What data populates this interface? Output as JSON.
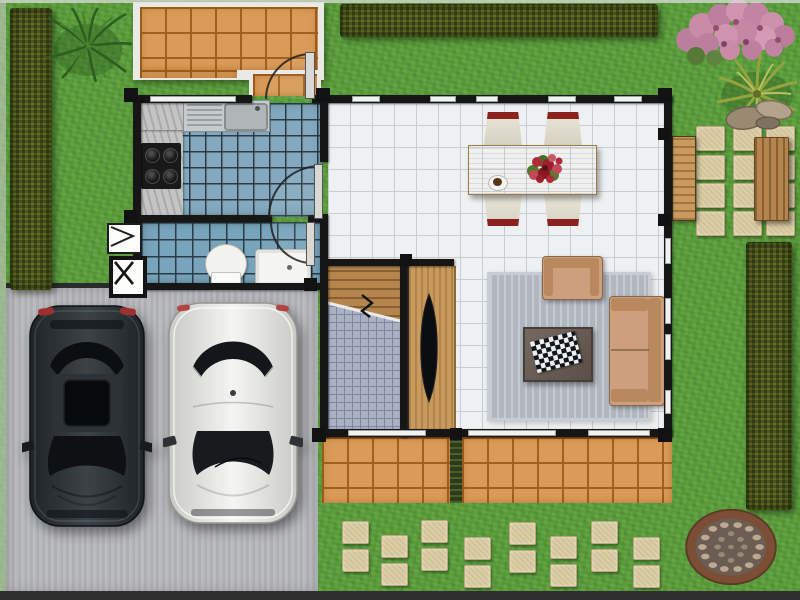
{
  "scene": {
    "name": "house-floor-plan-top-view",
    "width": 800,
    "height": 600
  },
  "palette": {
    "grass": "#5ca03c",
    "hedge": "#4a5520",
    "patioTile": "#d99b57",
    "patioGrout": "#a2601e",
    "kitchenTile": "#84a9be",
    "bathTile": "#79a5bc",
    "tileGrout": "#2b3b47",
    "floorTile": "#eef0f1",
    "floorGrout": "#c8cdd2",
    "wall": "#161616",
    "driveway": "#babbbf",
    "wood": "#b5854e",
    "woodDark": "#8a5f33",
    "rug": "#b1b7c0",
    "sofa": "#cd9f7c",
    "sofaDark": "#b8895f",
    "tableWood": "#d9ba7d",
    "stone": "#dccfa7",
    "stoneBorder": "#b9a87c",
    "wellRing": "#7c4e36",
    "chairSeat": "#e9e5d8",
    "chairBack": "#8c2220",
    "counter": "#c4c4c2",
    "stainless": "#c6cacc",
    "white": "#f2f2ef"
  },
  "garden": {
    "hedges": [
      {
        "name": "hedge-left",
        "x": 10,
        "y": 8,
        "w": 42,
        "h": 282
      },
      {
        "name": "hedge-top",
        "x": 340,
        "y": 4,
        "w": 318,
        "h": 33
      },
      {
        "name": "hedge-right",
        "x": 746,
        "y": 242,
        "w": 46,
        "h": 268
      }
    ],
    "plants": [
      {
        "name": "ornamental-grass"
      },
      {
        "name": "blossom-tree"
      },
      {
        "name": "palm-plant"
      },
      {
        "name": "rock-cluster"
      }
    ],
    "right_path_stones": [
      {
        "x": 696,
        "y": 126,
        "w": 27,
        "h": 23
      },
      {
        "x": 733,
        "y": 126,
        "w": 27,
        "h": 23
      },
      {
        "x": 766,
        "y": 126,
        "w": 27,
        "h": 23
      },
      {
        "x": 696,
        "y": 155,
        "w": 27,
        "h": 23
      },
      {
        "x": 733,
        "y": 155,
        "w": 27,
        "h": 23
      },
      {
        "x": 766,
        "y": 155,
        "w": 27,
        "h": 23
      },
      {
        "x": 696,
        "y": 183,
        "w": 27,
        "h": 23
      },
      {
        "x": 733,
        "y": 183,
        "w": 27,
        "h": 23
      },
      {
        "x": 766,
        "y": 183,
        "w": 27,
        "h": 23
      },
      {
        "x": 696,
        "y": 211,
        "w": 27,
        "h": 23
      },
      {
        "x": 733,
        "y": 211,
        "w": 27,
        "h": 23
      },
      {
        "x": 766,
        "y": 211,
        "w": 27,
        "h": 23
      }
    ],
    "bottom_path_stones": [
      {
        "x": 342,
        "y": 521,
        "w": 25,
        "h": 21
      },
      {
        "x": 342,
        "y": 549,
        "w": 25,
        "h": 21
      },
      {
        "x": 381,
        "y": 535,
        "w": 25,
        "h": 21
      },
      {
        "x": 381,
        "y": 563,
        "w": 25,
        "h": 21
      },
      {
        "x": 421,
        "y": 520,
        "w": 25,
        "h": 21
      },
      {
        "x": 421,
        "y": 548,
        "w": 25,
        "h": 21
      },
      {
        "x": 464,
        "y": 537,
        "w": 25,
        "h": 21
      },
      {
        "x": 464,
        "y": 565,
        "w": 25,
        "h": 21
      },
      {
        "x": 509,
        "y": 522,
        "w": 25,
        "h": 21
      },
      {
        "x": 509,
        "y": 550,
        "w": 25,
        "h": 21
      },
      {
        "x": 550,
        "y": 536,
        "w": 25,
        "h": 21
      },
      {
        "x": 550,
        "y": 564,
        "w": 25,
        "h": 21
      },
      {
        "x": 591,
        "y": 521,
        "w": 25,
        "h": 21
      },
      {
        "x": 591,
        "y": 549,
        "w": 25,
        "h": 21
      },
      {
        "x": 633,
        "y": 537,
        "w": 25,
        "h": 21
      },
      {
        "x": 633,
        "y": 565,
        "w": 25,
        "h": 21
      }
    ],
    "bench": {
      "x": 754,
      "y": 137,
      "w": 33,
      "h": 82
    },
    "pebble_circle": {
      "x": 683,
      "y": 506,
      "w": 96,
      "h": 82
    }
  },
  "driveway": {
    "x": 6,
    "y": 288,
    "w": 312,
    "h": 304,
    "cars": [
      {
        "name": "dark-car",
        "body": "#2e3438"
      },
      {
        "name": "white-car",
        "body": "#ececea"
      }
    ]
  },
  "house": {
    "rooms": [
      {
        "name": "front-patio"
      },
      {
        "name": "kitchen"
      },
      {
        "name": "bathroom"
      },
      {
        "name": "living-dining-room"
      },
      {
        "name": "staircase"
      },
      {
        "name": "rear-terrace"
      }
    ],
    "windows": [
      {
        "x": 150,
        "y": 96,
        "w": 86,
        "h": 6
      },
      {
        "x": 352,
        "y": 96,
        "w": 28,
        "h": 6
      },
      {
        "x": 430,
        "y": 96,
        "w": 26,
        "h": 6
      },
      {
        "x": 476,
        "y": 96,
        "w": 22,
        "h": 6
      },
      {
        "x": 548,
        "y": 96,
        "w": 28,
        "h": 6
      },
      {
        "x": 614,
        "y": 96,
        "w": 28,
        "h": 6
      },
      {
        "x": 665,
        "y": 238,
        "w": 6,
        "h": 26
      },
      {
        "x": 665,
        "y": 298,
        "w": 6,
        "h": 26
      },
      {
        "x": 665,
        "y": 334,
        "w": 6,
        "h": 26
      },
      {
        "x": 665,
        "y": 390,
        "w": 6,
        "h": 24
      },
      {
        "x": 348,
        "y": 430,
        "w": 78,
        "h": 6
      },
      {
        "x": 468,
        "y": 430,
        "w": 88,
        "h": 6
      },
      {
        "x": 588,
        "y": 430,
        "w": 62,
        "h": 6
      }
    ],
    "wall_nubs": [
      {
        "x": 124,
        "y": 88,
        "w": 14,
        "h": 14
      },
      {
        "x": 316,
        "y": 88,
        "w": 14,
        "h": 14
      },
      {
        "x": 658,
        "y": 88,
        "w": 14,
        "h": 14
      },
      {
        "x": 124,
        "y": 210,
        "w": 13,
        "h": 13
      },
      {
        "x": 124,
        "y": 278,
        "w": 13,
        "h": 13
      },
      {
        "x": 304,
        "y": 278,
        "w": 13,
        "h": 13
      },
      {
        "x": 658,
        "y": 128,
        "w": 12,
        "h": 12
      },
      {
        "x": 658,
        "y": 214,
        "w": 12,
        "h": 12
      },
      {
        "x": 658,
        "y": 428,
        "w": 14,
        "h": 14
      },
      {
        "x": 312,
        "y": 428,
        "w": 14,
        "h": 14
      },
      {
        "x": 450,
        "y": 428,
        "w": 12,
        "h": 12
      },
      {
        "x": 400,
        "y": 254,
        "w": 12,
        "h": 12
      }
    ],
    "furniture": [
      {
        "name": "kitchen-sink"
      },
      {
        "name": "cooktop"
      },
      {
        "name": "toilet"
      },
      {
        "name": "bathroom-vanity"
      },
      {
        "name": "dining-table"
      },
      {
        "name": "dining-chair",
        "count": 4
      },
      {
        "name": "flower-centerpiece"
      },
      {
        "name": "coffee-cup"
      },
      {
        "name": "area-rug"
      },
      {
        "name": "sofa"
      },
      {
        "name": "armchair"
      },
      {
        "name": "coffee-table"
      },
      {
        "name": "chessboard"
      },
      {
        "name": "tv"
      },
      {
        "name": "tv-console"
      },
      {
        "name": "garden-bench"
      },
      {
        "name": "side-door"
      },
      {
        "name": "entrance-door"
      }
    ]
  }
}
